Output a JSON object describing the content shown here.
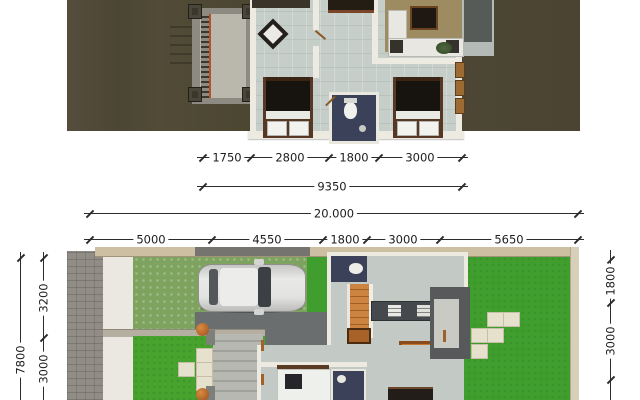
{
  "title": "two-storey-house-3d-floor-plans",
  "upper_plan": {
    "label": "second-floor-plan",
    "dim_segments": [
      "1750",
      "2800",
      "1800",
      "3000"
    ],
    "dim_total": "9350"
  },
  "lower_plan": {
    "label": "ground-floor-site-plan",
    "dim_total": "20.000",
    "dim_segments": [
      "5000",
      "4550",
      "1800",
      "3000",
      "5650"
    ],
    "dim_left_outer": "7800",
    "dim_left_segments": [
      "3200",
      "3000"
    ],
    "dim_right_segments": [
      "1800",
      "3000"
    ]
  },
  "colors": {
    "roof": "#4e4736",
    "upper_floor": "#c6cec9",
    "wall": "#eceae1",
    "bathroom_floor": "#3a4158",
    "bed_duvet": "#17130e",
    "bed_frame": "#573824",
    "stair_orange": "#c8813f",
    "dining_table": "#c8772f",
    "lawn_bright": "#43a22c",
    "lawn_olive": "#7da35f",
    "stone_fence": "#918d86",
    "boundary_wall_tan": "#cdbfa2",
    "paving_dark": "#6a6e6e",
    "entry_steps": "#b6b8b1",
    "kitchen_counter": "#45494e",
    "car_body": "#e2e2e0",
    "dim_text": "#1c1c1c"
  }
}
